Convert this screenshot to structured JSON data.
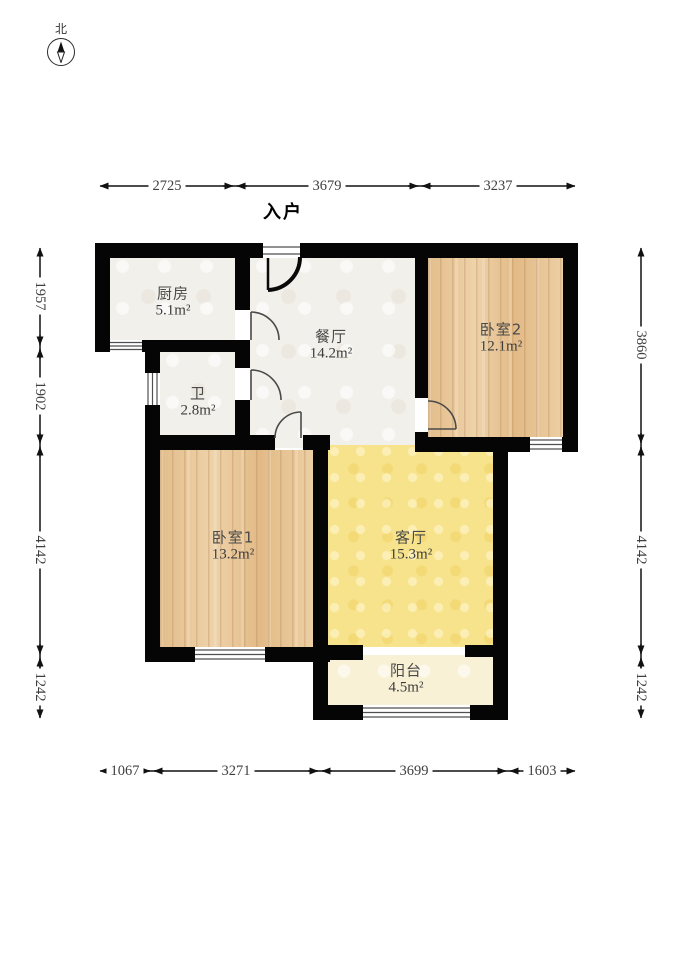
{
  "compass": {
    "label": "北"
  },
  "entry_label": "入户",
  "rooms": [
    {
      "id": "kitchen",
      "name": "厨房",
      "area": "5.1m²"
    },
    {
      "id": "bathroom",
      "name": "卫",
      "area": "2.8m²"
    },
    {
      "id": "dining",
      "name": "餐厅",
      "area": "14.2m²"
    },
    {
      "id": "bedroom2",
      "name": "卧室2",
      "area": "12.1m²"
    },
    {
      "id": "bedroom1",
      "name": "卧室1",
      "area": "13.2m²"
    },
    {
      "id": "living",
      "name": "客厅",
      "area": "15.3m²"
    },
    {
      "id": "balcony",
      "name": "阳台",
      "area": "4.5m²"
    }
  ],
  "dimensions": {
    "top": [
      "2725",
      "3679",
      "3237"
    ],
    "bottom": [
      "1067",
      "3271",
      "3699",
      "1603"
    ],
    "left": [
      "1957",
      "1902",
      "4142",
      "1242"
    ],
    "right": [
      "3860",
      "4142",
      "1242"
    ]
  },
  "colors": {
    "wall": "#050505",
    "tile_floor": "#f2f0ea",
    "wood_floor": "#e7c597",
    "living_floor": "#f7e38c",
    "balcony_floor": "#f8f1d6",
    "dimension_text": "#3f3f3f"
  }
}
